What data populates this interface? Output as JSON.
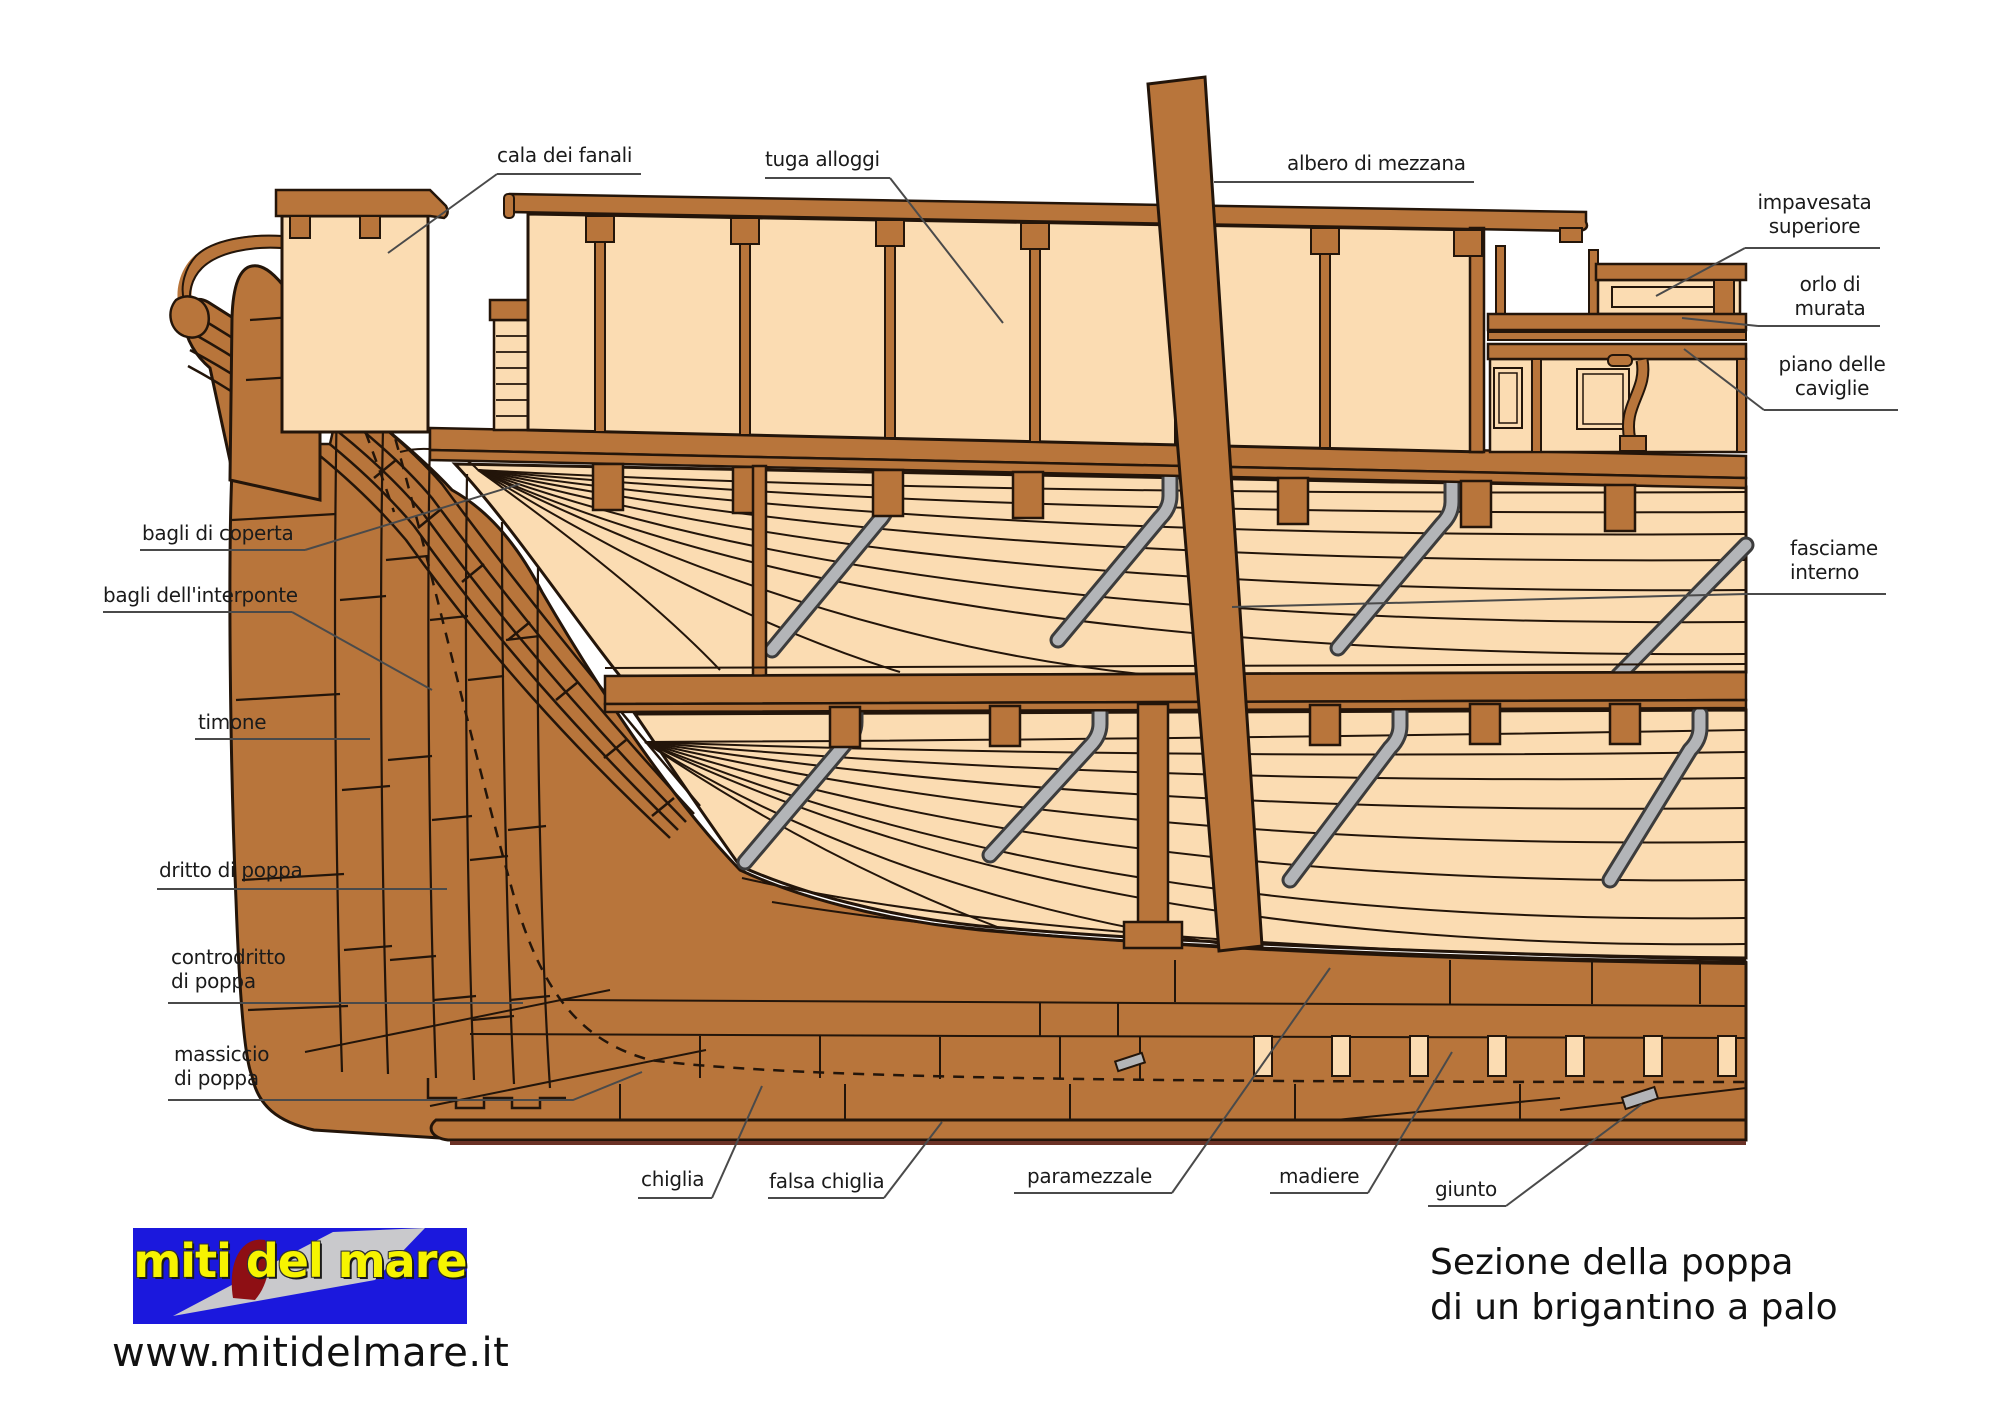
{
  "diagram": {
    "labels": {
      "cala_dei_fanali": "cala dei fanali",
      "tuga_alloggi": "tuga alloggi",
      "albero_di_mezzana": "albero di mezzana",
      "impavesata_superiore": "impavesata\nsuperiore",
      "orlo_di_murata": "orlo di\nmurata",
      "piano_delle_caviglie": "piano delle\ncaviglie",
      "fasciame_interno": "fasciame\ninterno",
      "bagli_di_coperta": "bagli di coperta",
      "bagli_dell_interponte": "bagli dell'interponte",
      "timone": "timone",
      "dritto_di_poppa": "dritto di poppa",
      "controdritto_di_poppa": "controdritto\ndi poppa",
      "massiccio_di_poppa": "massiccio\ndi poppa",
      "chiglia": "chiglia",
      "falsa_chiglia": "falsa chiglia",
      "paramezzale": "paramezzale",
      "madiere": "madiere",
      "giunto": "giunto"
    },
    "colors": {
      "wood_frame": "#b8753b",
      "wood_panel": "#fbdcb2",
      "outline": "#23150a",
      "metal_gray": "#b3b5b8",
      "logo_blue": "#1b18dd",
      "logo_yellow": "#f7f400",
      "logo_red": "#8e0f14"
    }
  },
  "footer": {
    "logo_text": "miti del mare",
    "website": "www.mitidelmare.it",
    "title": "Sezione della poppa\ndi un brigantino a palo"
  }
}
